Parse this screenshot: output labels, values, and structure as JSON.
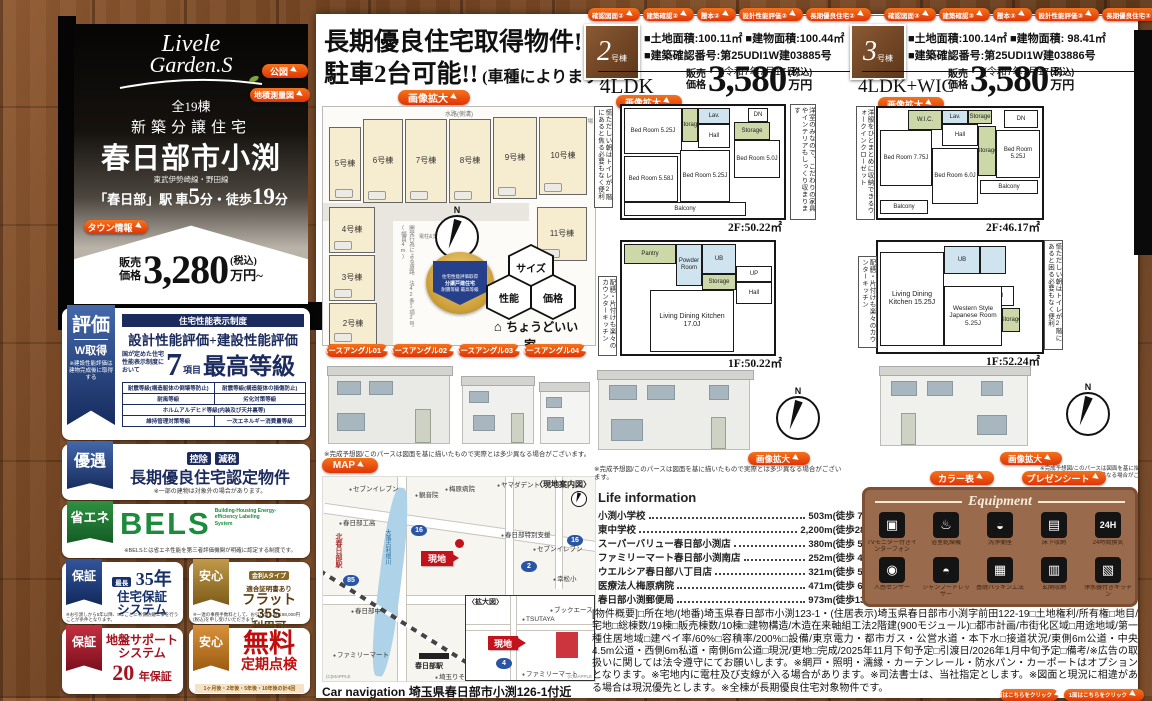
{
  "glyphs": {
    "north": "N"
  },
  "brand": {
    "logo_line1": "Livele",
    "logo_line2": "Garden.S",
    "total_units": "全19棟",
    "category": "新築分譲住宅",
    "title": "春日部市小渕",
    "rail_line": "東武伊勢崎線・野田線",
    "access_pre": "「春日部」駅 車",
    "access_num1": "5",
    "access_mid": "分・徒歩",
    "access_num2": "19",
    "access_suf": "分",
    "town_info": "タウン情報",
    "price_prefix1": "販売",
    "price_prefix2": "価格",
    "price": "3,280",
    "price_tax": "(税込)",
    "price_unit": "万円~"
  },
  "doc_buttons": {
    "kozu": "公図",
    "chiseki": "地積測量図"
  },
  "cert": {
    "ribbon": "評価",
    "ribbon_sub": "W取得",
    "ribbon_note": "※建設性能評価は建物完成後に取得する",
    "header": "住宅性能表示制度",
    "title": "設計性能評価+建設性能評価",
    "lead": "国が定めた住宅性能表示制度において",
    "count": "7",
    "count_unit": "項目",
    "grade": "最高等級",
    "items": [
      "耐震等級(構造躯体の倒壊等防止)",
      "耐震等級(構造躯体の損傷防止)",
      "耐風等級",
      "劣化対策等級",
      "ホルムアルデヒド等級(内装及び天井裏等)",
      "維持管理対策等級",
      "一次エネルギー消費量等級"
    ]
  },
  "yugu": {
    "ribbon": "優遇",
    "tag1": "控除",
    "tag2": "減税",
    "title": "長期優良住宅認定物件",
    "note": "※一部の建物は対象外の場合があります。"
  },
  "bels": {
    "ribbon": "省エネ",
    "title": "BELS",
    "subtitle": "Building-Housing Energy-efficiency Labeling System",
    "note": "※BELSとは省エネ性能を第三者評価機関が明確に認定する制度です。"
  },
  "warranty35": {
    "ribbon": "保証",
    "tag": "最長",
    "years": "35年",
    "title1": "住宅保証",
    "title2": "システム",
    "note": "※お引渡しから5年以降、5年ごとに有償防蟻工事を行うことが条件となります。"
  },
  "flat35": {
    "ribbon": "安心",
    "tag": "金利Aタイプ",
    "sub": "適合証明書あり",
    "title1": "フラット35S",
    "title2": "利用可",
    "note": "※一連の事務手数料として、お引き渡し時に88,000円(税込)を申し受けいただきます。"
  },
  "jiban": {
    "ribbon": "保証",
    "title1": "地盤サポート",
    "title2": "システム",
    "num": "20",
    "years": "年保証"
  },
  "teiki": {
    "ribbon": "安心",
    "title": "無料",
    "sub": "定期点検",
    "note": "1ヶ月後・2年後・5年後・10年後の計4回"
  },
  "center": {
    "headline1": "長期優良住宅取得物件!",
    "headline2": "駐車2台可能!!",
    "headline2_sub": "(車種によります)",
    "zoom_label": "画像拡大",
    "siteplan": {
      "waterway": "水路(側溝)",
      "trash": "ゴミ置場",
      "road_note": "開発行為による道路 法42条1項2号(幅員4m)",
      "pole_note": "電柱&支線",
      "lots": [
        "5号棟",
        "6号棟",
        "7号棟",
        "8号棟",
        "9号棟",
        "10号棟",
        "4号棟",
        "3号棟",
        "2号棟",
        "11号棟"
      ]
    },
    "medal": {
      "line1": "住宅性能評価取得",
      "line2": "分譲戸建住宅",
      "line3": "耐震等級 最高等級"
    },
    "hex": [
      "サイズ",
      "性能",
      "価格"
    ],
    "tagline": "ちょうどいい家。",
    "pers_buttons": [
      "パースアングル01",
      "パースアングル02",
      "パースアングル03",
      "パースアングル04"
    ],
    "map_button": "MAP",
    "map": {
      "title": "〈現地案内図〉",
      "inset_title": "〈拡大図〉",
      "site_label": "現地",
      "river": "大落古利根川",
      "station1": "北春日部駅",
      "station2": "春日部駅",
      "routes": [
        "16",
        "85",
        "2",
        "16",
        "4"
      ],
      "pois": [
        "セブンイレブン",
        "観音院",
        "梅原病院",
        "ヤマダデント",
        "春日部特別支援",
        "セブンイレブン",
        "春日部工高",
        "春日部中",
        "幸松小",
        "ファミリーマート",
        "埼玉りそな"
      ],
      "inset_pois": [
        "ブックエース",
        "TSUTAYA",
        "ファミリーマート"
      ],
      "credit": "(C)MAPPLE"
    },
    "carnav_label": "Car navigation",
    "carnav": "埼玉県春日部市小渕126-1付近"
  },
  "captions": {
    "render": "※完成予想図/このパースは図面を基に描いたもので実際とは多少異なる場合がございます。"
  },
  "units": [
    {
      "tabs": [
        "確認図面②",
        "建築確認②",
        "謄本②",
        "設計性能評価②",
        "長期優良住宅②"
      ],
      "num": "2",
      "num_suffix": "号棟",
      "land": "■土地面積:100.11㎡",
      "building": "■建物面積:100.44㎡",
      "confirmation": "■建築確認番号:第25UDI1W建03885号",
      "confirmation_date": "(令和7年7月17日)",
      "layout": "4LDK",
      "price_prefix1": "販売",
      "price_prefix2": "価格",
      "price": "3,580",
      "price_tax": "(税込)",
      "price_unit": "万円",
      "zoom_label": "画像拡大",
      "note_left2f": "慌ただしい朝はトイレが2階にあると焦る必要もなく便利",
      "note_right2f": "洋室のみなので、こだわりの家具やインテリアもしっくり収まります",
      "note_left1f": "配膳・片付けも楽々のカウンターキッチン",
      "floor2_area": "2F:50.22㎡",
      "floor1_area": "1F:50.22㎡",
      "rooms2f": {
        "r1": "Bed Room 5.25J",
        "r2": "Storage",
        "r3": "Lav.",
        "r4": "Hall",
        "r5": "DN",
        "r6": "Storage",
        "r7": "Bed Room 5.0J",
        "r8": "Bed Room 5.58J",
        "r9": "Bed Room 5.25J",
        "r10": "Balcony"
      },
      "rooms1f": {
        "r1": "Pantry",
        "r2": "Powder Room",
        "r3": "UB",
        "r4": "Storage",
        "r5": "UP",
        "r6": "Hall",
        "r7": "Living Dining Kitchen 17.0J"
      }
    },
    {
      "tabs": [
        "確認図面③",
        "建築確認③",
        "謄本③",
        "設計性能評価③",
        "長期優良住宅③"
      ],
      "num": "3",
      "num_suffix": "号棟",
      "land": "■土地面積:100.14㎡",
      "building": "■建物面積: 98.41㎡",
      "confirmation": "■建築確認番号:第25UDI1W建03886号",
      "confirmation_date": "(令和7年7月17日)",
      "layout": "4LDK+WIC",
      "price_prefix1": "販売",
      "price_prefix2": "価格",
      "price": "3,580",
      "price_tax": "(税込)",
      "price_unit": "万円",
      "zoom_label": "画像拡大",
      "note_left2f": "洋服をひとまとめに収納できるウォークインクローゼット",
      "note_left1f": "配膳・片付けも楽々のカウンターキッチン",
      "note_right1f": "慌ただしい朝はトイレが2階にあると困る必要もなく便利",
      "floor2_area": "2F:46.17㎡",
      "floor1_area": "1F:52.24㎡",
      "rooms2f": {
        "r1": "W.I.C.",
        "r2": "Lav.",
        "r3": "Storage",
        "r4": "DN",
        "r5": "Hall",
        "r6": "Bed Room 7.75J",
        "r7": "Bed Room 6.0J",
        "r8": "Storage",
        "r9": "Bed Room 5.25J",
        "r10": "Balcony",
        "r11": "Balcony"
      },
      "rooms1f": {
        "r1": "UB",
        "r2": "Hall",
        "r3": "Living Dining Kitchen 15.25J",
        "r4": "Western Style Japanese Room 5.25J",
        "r5": "Storage"
      }
    }
  ],
  "life": {
    "title": "Life information",
    "items": [
      {
        "name": "小渕小学校",
        "dist": "503m(徒歩 7 分)"
      },
      {
        "name": "東中学校",
        "dist": "2,200m(徒歩28分)"
      },
      {
        "name": "スーパーバリュー春日部小渕店",
        "dist": "380m(徒歩 5 分)"
      },
      {
        "name": "ファミリーマート春日部小渕南店",
        "dist": "252m(徒歩 4 分)"
      },
      {
        "name": "ウエルシア春日部八丁目店",
        "dist": "321m(徒歩 5 分)"
      },
      {
        "name": "医療法人梅原病院",
        "dist": "471m(徒歩 6 分)"
      },
      {
        "name": "春日部小渕郵便局",
        "dist": "973m(徒歩13分)"
      }
    ]
  },
  "equipment": {
    "color_button": "カラー表",
    "present_button": "プレゼンシート",
    "title": "Equipment",
    "icons": [
      "▣",
      "♨",
      "◒",
      "▤",
      "24H",
      "◉",
      "◓",
      "▦",
      "▥",
      "▧"
    ],
    "items": [
      "TVモニター付きインターフォン",
      "浴室乾燥機",
      "洗浄便座",
      "床下収納",
      "24時間換気",
      "人感センサー",
      "シャンプードレッサー",
      "基礎パッキン工法",
      "玄関収納",
      "浄水器付きキッチン"
    ]
  },
  "overview": "[物件概要]□所在地/(地番)埼玉県春日部市小渕123-1・(住居表示)埼玉県春日部市小渕字前田122-19□土地権利/所有権□地目/宅地□総棟数/19棟□販売棟数/10棟□建物構造/木造在来軸組工法2階建(900モジュール)□都市計画/市街化区域□用途地域/第一種住居地域□建ペイ率/60%□容積率/200%□設備/東京電力・都市ガス・公営水道・本下水□接道状況/東側6m公道・中央4.5m公道・西側6m私道・南側6m公道□現況/更地□完成/2025年11月下旬予定□引渡日/2026年1月中旬予定□備考/※広告の取扱いに関しては法令遵守にてお願いします。※網戸・照明・濡縁・カーテンレール・防水パン・カーポートはオプションとなります。※宅地内に電柱及び支線が入る場合があります。※司法書士は、当社指定とします。※図面と現況に相違がある場合は現況優先とします。※全棟が長期優良住宅対象物件です。",
  "footer_links": [
    "1面はこちらをクリック",
    "1面はこちらをクリック"
  ]
}
